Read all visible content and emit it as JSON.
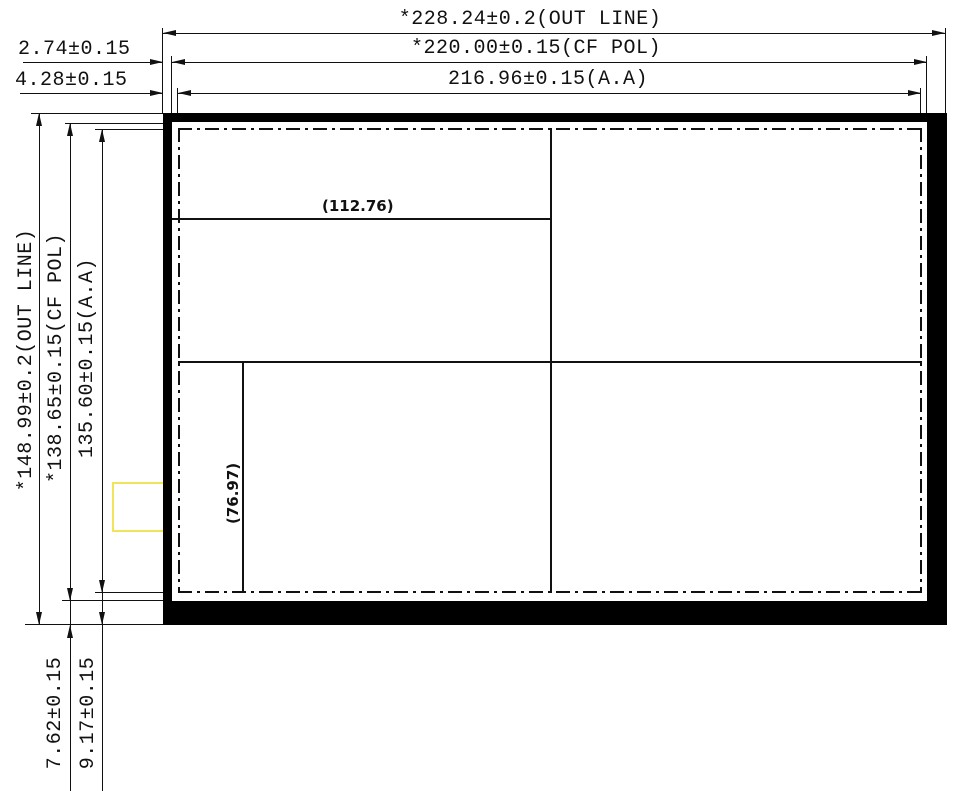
{
  "drawing": {
    "top_dimensions": [
      {
        "label": "*228.24±0.2(OUT LINE)"
      },
      {
        "label": "*220.00±0.15(CF POL)"
      },
      {
        "label": "216.96±0.15(A.A)"
      }
    ],
    "left_edge_offsets": [
      {
        "label": "2.74±0.15"
      },
      {
        "label": "4.28±0.15"
      }
    ],
    "left_dimensions": [
      {
        "label": "*148.99±0.2(OUT LINE)"
      },
      {
        "label": "*138.65±0.15(CF POL)"
      },
      {
        "label": "135.60±0.15(A.A)"
      }
    ],
    "bottom_edge_offsets": [
      {
        "label": "7.62±0.15"
      },
      {
        "label": "9.17±0.15"
      }
    ],
    "reference_dimensions": [
      {
        "label": "(112.76)"
      },
      {
        "label": "(76.97)"
      }
    ],
    "colors": {
      "line": "#111111",
      "panel_border": "#000000",
      "highlight": "#f0e45b",
      "background": "#ffffff"
    }
  }
}
